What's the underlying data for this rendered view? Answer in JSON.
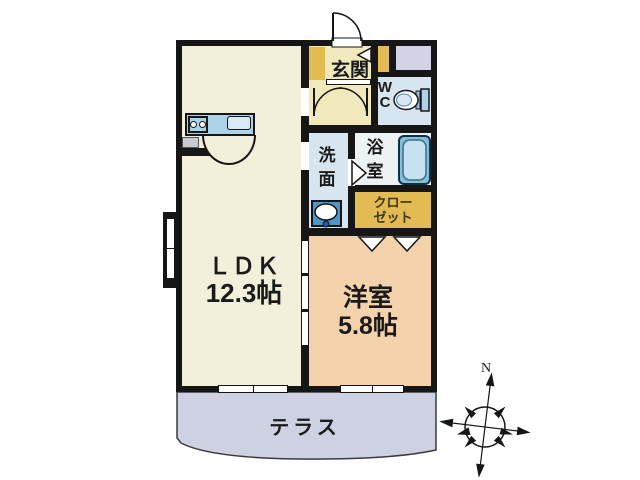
{
  "title": "apartment floor plan",
  "rooms": {
    "ldk": {
      "label": "ＬＤＫ",
      "size": "12.3帖"
    },
    "western": {
      "label": "洋室",
      "size": "5.8帖"
    },
    "entrance": {
      "label": "玄関"
    },
    "wc": {
      "lines": [
        "W",
        "C"
      ]
    },
    "washroom": {
      "chars": [
        "洗",
        "面"
      ]
    },
    "bathroom": {
      "chars": [
        "浴",
        "室"
      ]
    },
    "closet": {
      "lines": [
        "クロー",
        "ゼット"
      ]
    },
    "terrace": {
      "label": "テラス"
    }
  },
  "compass": {
    "north_label": "N"
  },
  "colors": {
    "wall": "#161616",
    "text": "#1a1a1a",
    "ldk": "#F2F0DA",
    "genkan": "#F1E8BC",
    "gold": "#E2BC52",
    "lavender": "#D2D3E6",
    "waterfloor": "#D7E5F0",
    "bathfloor": "#EDF2F4",
    "tub": "#84C0DB",
    "tubinner": "#C5E2F0",
    "kitchen": "#AED2E8",
    "sinkfill": "#D8EAF5",
    "western": "#F4D2AB",
    "terracefill": "#CDD1E2",
    "graybox": "#C9CBD3",
    "closettext": "#3d3415"
  }
}
